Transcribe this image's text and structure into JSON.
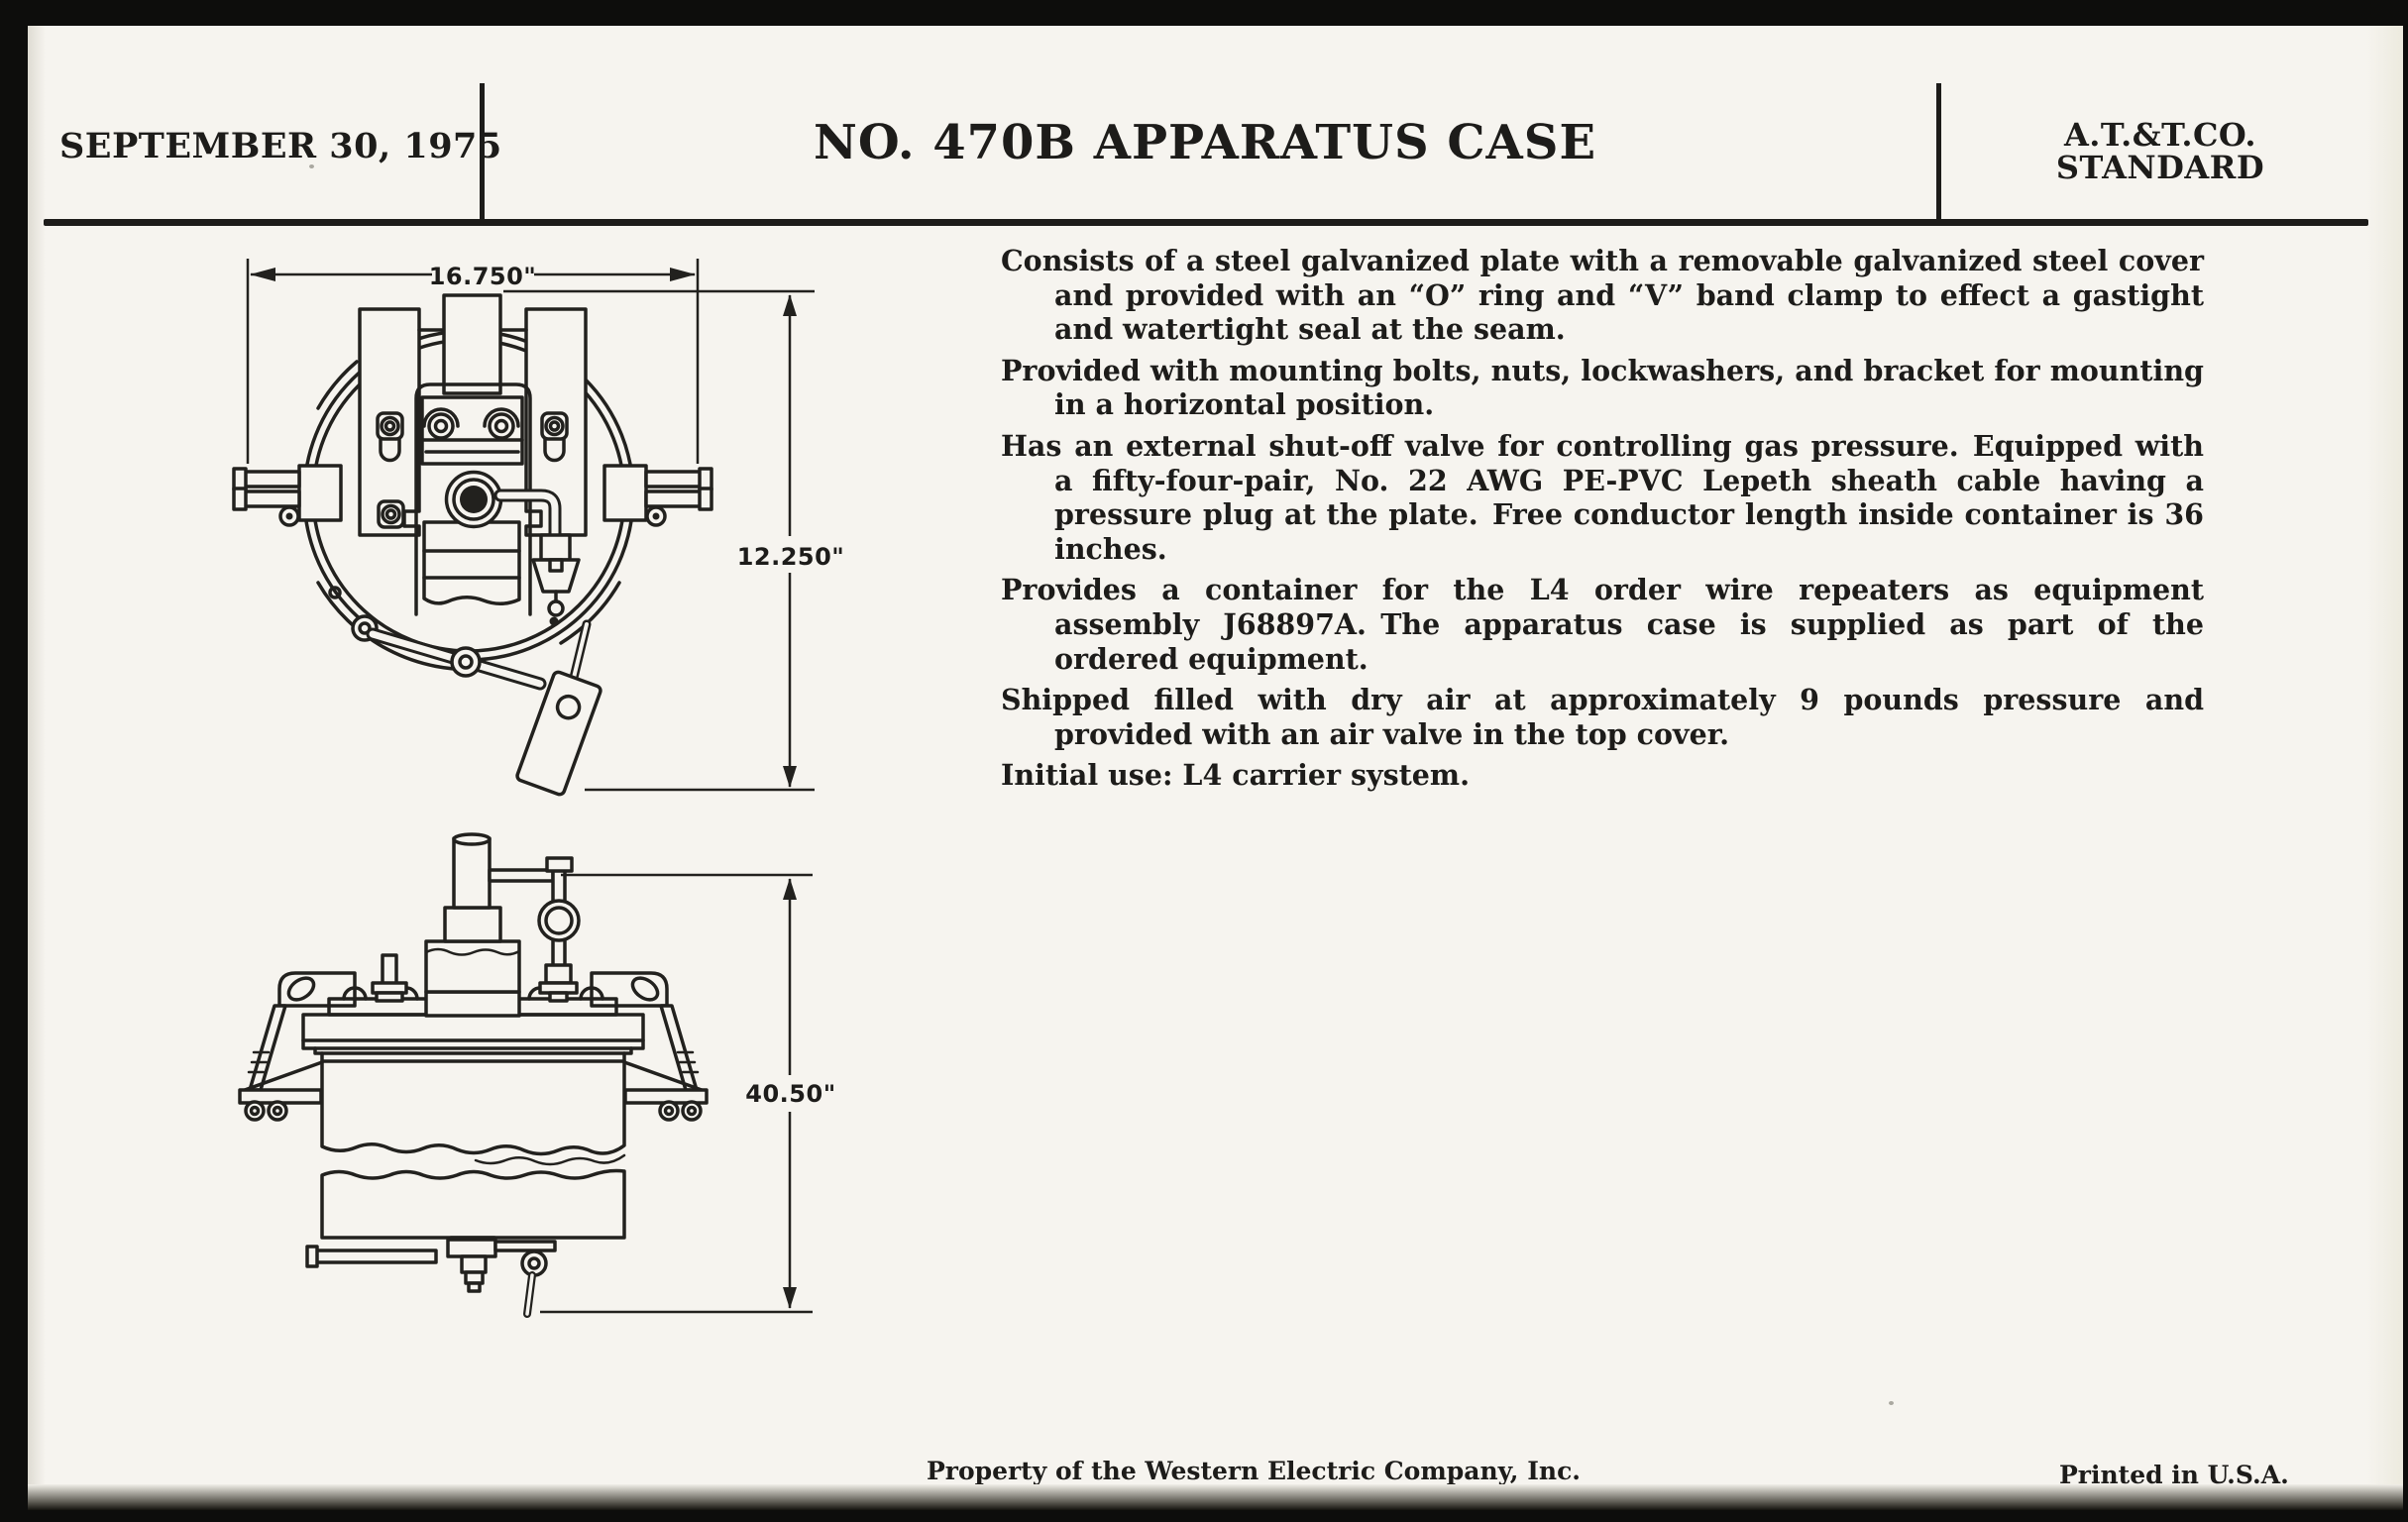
{
  "page": {
    "paper": "#f6f4ef",
    "ink": "#1d1c1a"
  },
  "header": {
    "date": "SEPTEMBER 30, 1975",
    "title": "NO. 470B APPARATUS CASE",
    "org": {
      "line1": "A.T.&T.CO.",
      "line2": "STANDARD"
    }
  },
  "spec": {
    "paragraphs": [
      "Consists of a steel galvanized plate with a removable galvanized steel cover and provided with an “O” ring and “V” band clamp to effect a gastight and watertight seal at the seam.",
      "Provided with mounting bolts, nuts, lockwashers, and bracket for mounting in a horizontal position.",
      "Has an external shut-off valve for controlling gas pressure. Equipped with a fifty-four-pair, No. 22 AWG PE-PVC Lepeth sheath cable having a pressure plug at the plate. Free conductor length inside container is 36 inches.",
      "Provides a container for the L4 order wire repeaters as equipment assembly J68897A. The apparatus case is supplied as part of the ordered equipment.",
      "Shipped filled with dry air at approximately 9 pounds pressure and provided with an air valve in the top cover.",
      "Initial use: L4 carrier system."
    ]
  },
  "drawings": {
    "top_view": {
      "width_dim": "16.750\"",
      "height_dim": "12.250\""
    },
    "side_view": {
      "height_dim": "40.50\""
    }
  },
  "footer": {
    "property_line": "Property of the Western Electric Company, Inc.",
    "printed_line": "Printed in U.S.A."
  }
}
